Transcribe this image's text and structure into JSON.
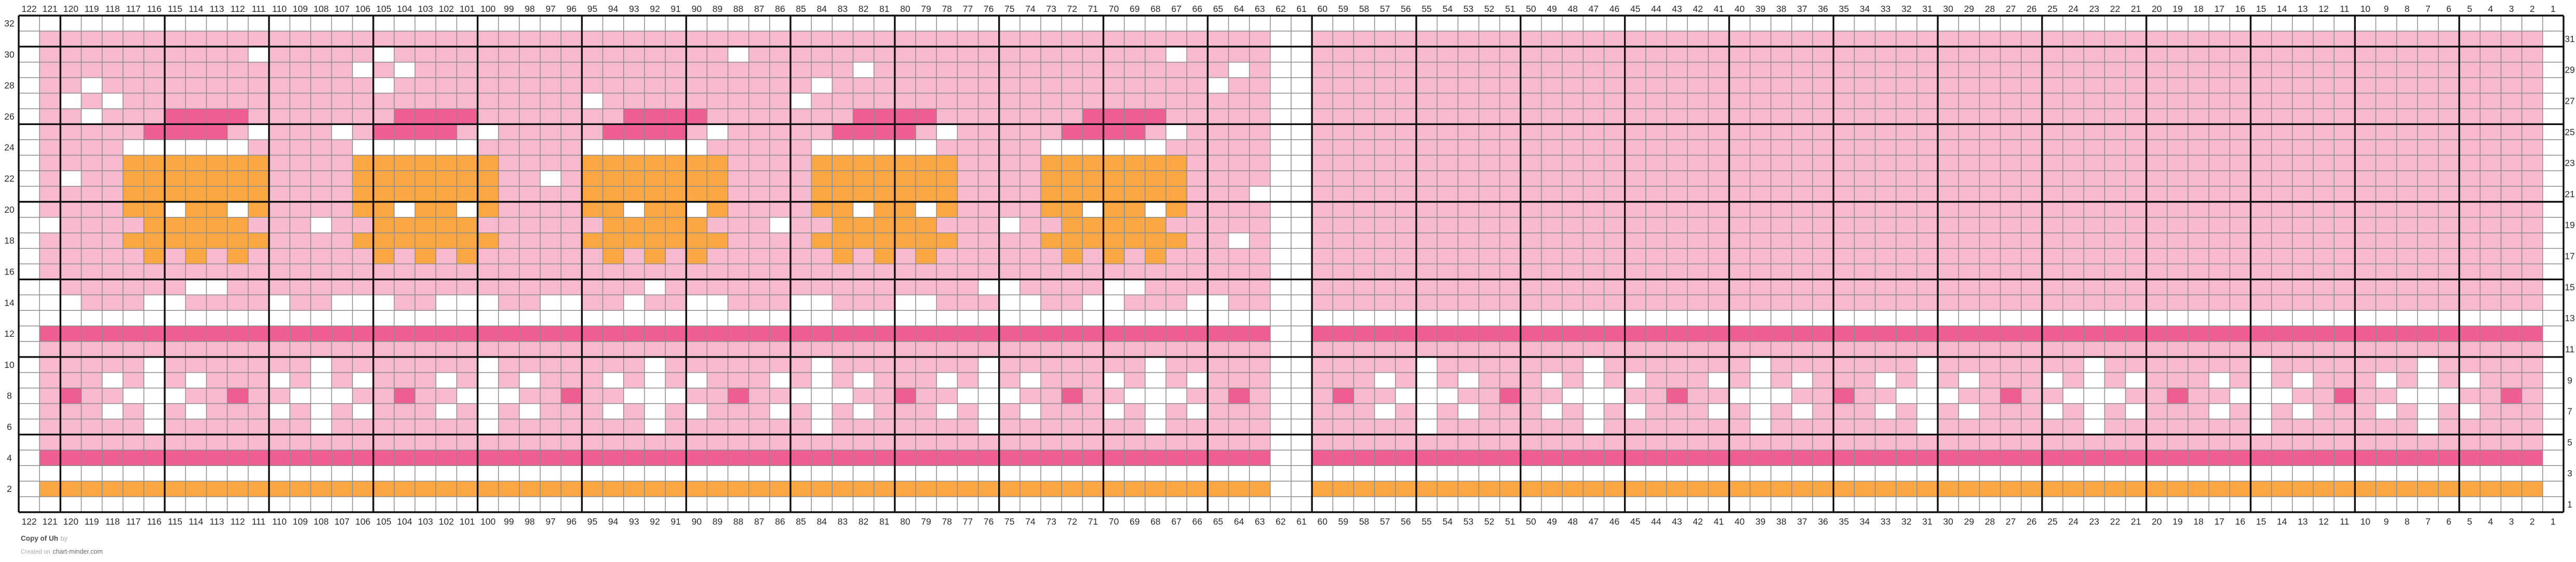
{
  "credits": {
    "title": "Copy of Uh",
    "by_label": "by",
    "created_on_label": "Created on",
    "site": "chart-minder.com"
  },
  "axis": {
    "columns_left_to_right": [
      122,
      121,
      120,
      119,
      118,
      117,
      116,
      115,
      114,
      113,
      112,
      111,
      110,
      109,
      108,
      107,
      106,
      105,
      104,
      103,
      102,
      101,
      100,
      99,
      98,
      97,
      96,
      95,
      94,
      93,
      92,
      91,
      90,
      89,
      88,
      87,
      86,
      85,
      84,
      83,
      82,
      81,
      80,
      79,
      78,
      77,
      76,
      75,
      74,
      73,
      72,
      71,
      70,
      69,
      68,
      67,
      66,
      65,
      64,
      63,
      62,
      61,
      60,
      59,
      58,
      57,
      56,
      55,
      54,
      53,
      52,
      51,
      50,
      49,
      48,
      47,
      46,
      45,
      44,
      43,
      42,
      41,
      40,
      39,
      38,
      37,
      36,
      35,
      34,
      33,
      32,
      31,
      30,
      29,
      28,
      27,
      26,
      25,
      24,
      23,
      22,
      21,
      20,
      19,
      18,
      17,
      16,
      15,
      14,
      13,
      12,
      11,
      10,
      9,
      8,
      7,
      6,
      5,
      4,
      3,
      2,
      1
    ],
    "row_labels_left_top_to_bottom": [
      32,
      30,
      28,
      26,
      24,
      22,
      20,
      18,
      16,
      14,
      12,
      10,
      8,
      6,
      4,
      2
    ],
    "row_labels_right_top_to_bottom": [
      31,
      29,
      27,
      25,
      23,
      21,
      19,
      17,
      15,
      13,
      11,
      9,
      7,
      5,
      3,
      1
    ]
  },
  "chart_data": {
    "type": "heatmap",
    "subtype": "knitting-colorwork-chart",
    "grid_columns": 122,
    "grid_rows": 32,
    "bold_gridline_every": 5,
    "legend": {
      "P": {
        "name": "light-pink background",
        "hex": "#F7B9CE"
      },
      "D": {
        "name": "dark-pink accent",
        "hex": "#EE5E93"
      },
      "O": {
        "name": "orange accent",
        "hex": "#FAA743"
      },
      "W": {
        "name": "white / empty",
        "hex": "#FFFFFF"
      }
    },
    "rows_top_to_bottom_rle": [
      "122W",
      "1W 59P 2W 59P 1W",
      "1W 10P 1W 5P 1W 16P 1W 20P 1W 4P 2W 59P 1W",
      "1W 15P 1W 1P 1W 21P 1W 17P 1W 1P 2W 59P 1W",
      "1W 2P 1W 13P 1W 20P 1W 18P 1W 2P 2W 59P 1W",
      "1W 1P 1W 1P 1W 22P 1W 9P 1W 22P 2W 59P 1W",
      "1W 2P 1W 3P 4D 7P 4D 7P 4D 7P 4D 7P 4D 5P 2W 59P 1W",
      "1W 5P 4D 1P 1W 3P 1W 1P 4D 1P 1W 5P 4D 1P 1W 5P 4D 1P 1W 5P 4D 1P 1W 4P 2W 59P 1W",
      "1W 4P 6W 5P 6W 5P 6W 5P 6W 5P 6W 5P 2W 59P 1W",
      "1W 4P 7O 4P 7O 4P 7O 4P 7O 4P 7O 4P 2W 59P 1W",
      "1W 1P 1W 2P 7O 4P 7O 2P 1W 1P 7O 4P 7O 4P 7O 4P 2W 59P 1W",
      "1W 4P 7O 4P 7O 4P 7O 4P 7O 4P 7O 3P 3W 59P 1W",
      "1W 4P 2O 1W 2O 1W 1O 4P 2O 1W 2O 1W 1O 4P 2O 1W 2O 1W 1O 4P 2O 1W 2O 1W 1O 4P 2O 1W 2O 1W 1O 4P 2W 59P 1W",
      "2W 4P 5O 3P 1W 2P 5O 6P 5O 3P 1W 2P 5O 3P 1W 2P 5O 5P 2W 59P 1W",
      "1W 4P 7O 4P 7O 4P 7O 4P 7O 4P 7O 2P 1W 1P 2W 59P 1W",
      "1W 5P 1O 1P 1O 1P 1O 6P 1O 1P 1O 1P 1O 6P 1O 1P 1O 1P 1O 6P 1O 1P 1O 1P 1O 6P 1O 1P 1O 1P 1O 5P 2W 59P 1W",
      "1W 59P 2W 59P 1W",
      "2W 6P 2W 20P 1W 15P 2W 4P 2W 6P 2W 59P 1W",
      "3W 3P 2W 4P 1W 2P 3W 2P 3W 2P 2W 2P 1W 2P 2W 3P 2W 3P 2W 3P 2W 2P 2W 3P 2W 2P 2W 59P 1W",
      "122W",
      "1W 59D 2W 59D 1W",
      "1W 59P 2W 59P 1W",
      "1W 5P 1W 7P 1W 7P 1W 7P 1W 7P 1W 7P 1W 7P 1W 5P 2W 5P 1W 7P 1W 7P 1W 7P 1W 7P 1W 7P 1W 7P 1W 5P 1W",
      "1W 3P 1W 1P 1W 1P 1W 3P 1W 1P 1W 1P 1W 3P 1W 1P 1W 1P 1W 3P 1W 1P 1W 1P 1W 3P 1W 1P 1W 1P 1W 3P 1W 1P 1W 1P 1W 3P 1W 1P 1W 1P 1W 3P 2W 3P 1W 1P 1W 1P 1W 3P 1W 1P 1W 1P 1W 3P 1W 1P 1W 1P 1W 3P 1W 1P 1W 1P 1W 3P 1W 1P 1W 1P 1W 3P 1W 1P 1W 1P 1W 3P 1W 1P 1W 1P 1W 3P 1W",
      "1W 1P 1D 2P 3W 2P 1D 2P 3W 2P 1D 2P 3W 2P 1D 2P 3W 2P 1D 2P 3W 2P 1D 2P 3W 2P 1D 2P 3W 2P 1D 1P 2W 1P 1D 2P 3W 2P 1D 2P 3W 2P 1D 2P 3W 2P 1D 2P 3W 2P 1D 2P 3W 2P 1D 2P 3W 2P 1D 2P 3W 2P 1D 1P 1W",
      "1W 3P 1W 1P 1W 1P 1W 3P 1W 1P 1W 1P 1W 3P 1W 1P 1W 1P 1W 3P 1W 1P 1W 1P 1W 3P 1W 1P 1W 1P 1W 3P 1W 1P 1W 1P 1W 3P 1W 1P 1W 1P 1W 3P 2W 3P 1W 1P 1W 1P 1W 3P 1W 1P 1W 1P 1W 3P 1W 1P 1W 1P 1W 3P 1W 1P 1W 1P 1W 3P 1W 1P 1W 1P 1W 3P 1W 1P 1W 1P 1W 3P 1W 1P 1W 1P 1W 3P 1W",
      "1W 5P 1W 7P 1W 7P 1W 7P 1W 7P 1W 7P 1W 7P 1W 5P 2W 5P 1W 7P 1W 7P 1W 7P 1W 7P 1W 7P 1W 7P 1W 5P 1W",
      "1W 59P 2W 59P 1W",
      "1W 59D 2W 59D 1W",
      "122W",
      "1W 59O 2W 59O 1W",
      "122W"
    ],
    "title": "Copy of Uh",
    "notes": {
      "crown_motif_dark_band_columns": [
        115,
        104,
        93,
        82,
        71
      ],
      "snowflake_centers_left_panel": [
        116,
        108,
        100,
        92,
        84,
        76,
        68
      ],
      "snowflake_centers_right_panel": [
        55,
        47,
        39,
        31,
        23,
        15,
        7
      ],
      "dark_dot_row8_columns": [
        120,
        112,
        104,
        96,
        88,
        80,
        72,
        64,
        59,
        51,
        43,
        35,
        27,
        19,
        11,
        3
      ],
      "white_divider_columns": [
        62,
        61
      ],
      "white_edge_columns": [
        122,
        1
      ]
    }
  },
  "style": {
    "color_background": "#FFFFFF",
    "color_pink": "#F7B9CE",
    "color_dark_pink": "#EE5E93",
    "color_orange": "#FAA743",
    "color_grid_minor": "#8C8C8C",
    "color_grid_bold": "#101010",
    "color_axis_text": "#2B2B2B"
  }
}
